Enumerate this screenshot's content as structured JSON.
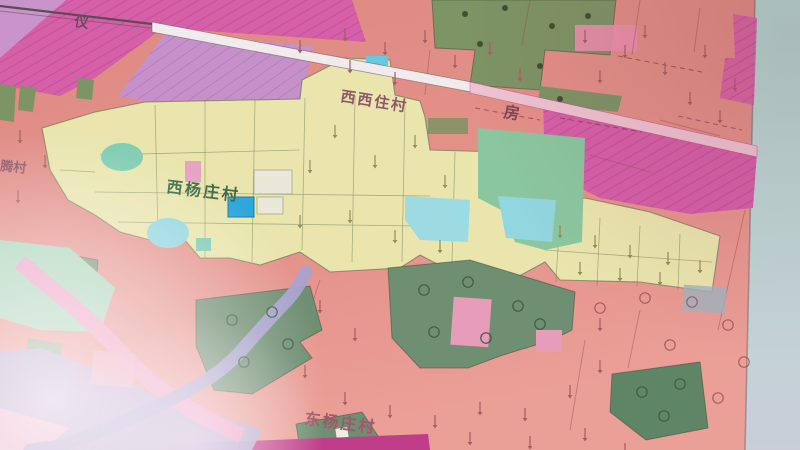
{
  "photo": {
    "description": "photograph of a village land-use planning map",
    "map": {
      "labels": {
        "top_village": "西西住村",
        "fang": "房",
        "center_village": "西杨庄村",
        "bottom_village": "东杨庄村",
        "left_edge_partial": "腾村",
        "top_left": "仪"
      },
      "colors": {
        "wall_teal": "#b6dbd3",
        "base_salmon": "#e28e86",
        "magenta_zone": "#d560a8",
        "purple_zone": "#c691cb",
        "village_yellow": "#e9e5ad",
        "olive_green": "#7d9465",
        "sage_green": "#6f8f72",
        "dark_green": "#5e8566",
        "mint_green": "#a5d6b8",
        "pond_teal": "#7fccb2",
        "pond_cyan": "#92d6df",
        "water_blue": "#2fa7da",
        "river_lavender": "#a9a2cf",
        "pink_band": "#ef9ec4",
        "road_white": "#f1ebee",
        "road_pink": "#eec3d2",
        "bottom_strip_magenta": "#bf3d89"
      }
    }
  }
}
